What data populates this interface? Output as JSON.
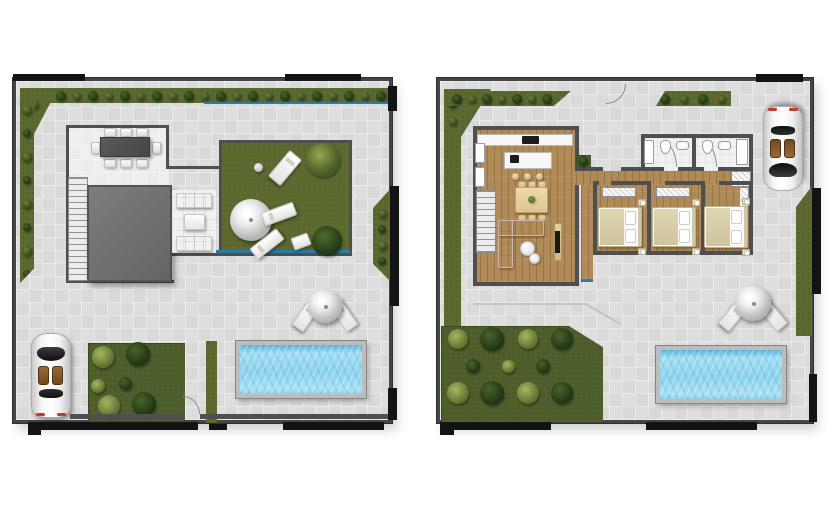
{
  "meta": {
    "canvas": {
      "width": 840,
      "height": 516
    },
    "plan_count": 2
  },
  "palette": {
    "paving": "#dedede",
    "wall": "#4f4f4f",
    "hedge": "#5c6a30",
    "lawn": "#5d6b31",
    "garden": "#50602c",
    "wood": "#b18b57",
    "teal": "#2a7ca6",
    "pool_water": "#8bd3ee",
    "pool_frame": "#bdbdbd",
    "bush_dark": "#1f3314",
    "bush_light": "#a3b75f",
    "sofa_pink": "#f0e2e0",
    "bed_blanket": "#d8cfae",
    "car_body": "#ffffff",
    "car_seats": "#8a5c2c",
    "shadow": "#131313"
  },
  "plans": {
    "left": {
      "name": "roof-terrace-site-plan",
      "features": [
        "perimeter-hedge",
        "dining-table-8-chairs",
        "stair-core-block",
        "roof-stairs",
        "lounge-sofa-set",
        "roof-garden-lawn",
        "sun-loungers",
        "parasols",
        "parked-convertible-car",
        "garden-patch",
        "swimming-pool",
        "entrance-gate",
        "glass-balustrade"
      ],
      "counts": {
        "sun_loungers": 6,
        "parasols": 2,
        "trees": 2,
        "cars": 1,
        "pools": 1,
        "dining_chairs": 8,
        "sofas": 2
      },
      "bush_groups": {
        "hedge_top": {
          "container": "lp-hedge-top",
          "count": 23,
          "d": 10,
          "tones": [
            "dark",
            "mid"
          ]
        },
        "hedge_left": {
          "container": "lp-hedge-left",
          "count": 8,
          "d": 10,
          "axis": "y",
          "tones": [
            "mid",
            "dark"
          ]
        },
        "hedge_corner": {
          "container": "lp-hedge-corner",
          "items": [
            {
              "x": 14,
              "y": 16,
              "d": 9,
              "tone": "mid"
            },
            {
              "x": 8,
              "y": 33,
              "d": 8,
              "tone": "dark"
            }
          ]
        },
        "right_strip": {
          "container": "lp-right-strip",
          "items": [
            {
              "x": 9,
              "y": 26,
              "d": 9,
              "tone": "mid"
            },
            {
              "x": 9,
              "y": 42,
              "d": 8,
              "tone": "dark"
            },
            {
              "x": 9,
              "y": 58,
              "d": 9,
              "tone": "mid"
            },
            {
              "x": 9,
              "y": 74,
              "d": 8,
              "tone": "dark"
            }
          ]
        },
        "roof_garden_trees": {
          "container": "lp-roof-garden",
          "items": [
            {
              "x": 101,
              "y": 17,
              "d": 34,
              "tone": "tree-light"
            },
            {
              "x": 105,
              "y": 98,
              "d": 30,
              "tone": "tree-dark"
            }
          ]
        },
        "garden_patch": {
          "container": "lp-garden",
          "items": [
            {
              "x": 15,
              "y": 14,
              "d": 22,
              "tone": "light"
            },
            {
              "x": 50,
              "y": 11,
              "d": 24,
              "tone": "dark"
            },
            {
              "x": 10,
              "y": 43,
              "d": 14,
              "tone": "light"
            },
            {
              "x": 37,
              "y": 40,
              "d": 13,
              "tone": "dark"
            },
            {
              "x": 21,
              "y": 63,
              "d": 22,
              "tone": "light"
            },
            {
              "x": 56,
              "y": 61,
              "d": 24,
              "tone": "dark"
            }
          ]
        }
      }
    },
    "right": {
      "name": "ground-floor-plan",
      "features": [
        "perimeter-hedge",
        "kitchen-counter",
        "kitchen-island",
        "dining-table-6-chairs",
        "living-room-sofa",
        "tv-unit",
        "staircase",
        "hallway",
        "bedrooms",
        "bathrooms",
        "shower",
        "wardrobes",
        "entry-planter",
        "parked-convertible-car",
        "garden",
        "swimming-pool",
        "sun-loungers",
        "parasol",
        "entrance-gate"
      ],
      "counts": {
        "bedrooms": 3,
        "beds": 3,
        "bathrooms": 2,
        "wardrobes": 3,
        "sun_loungers": 2,
        "parasols": 1,
        "cars": 1,
        "pools": 1,
        "dining_chairs": 6,
        "kitchen_stools": 3
      },
      "bush_groups": {
        "hedge_top_left": {
          "container": "rp-hedge-a",
          "count": 8,
          "d": 10,
          "tones": [
            "dark",
            "mid"
          ]
        },
        "hedge_top_right": {
          "container": "rp-hedge-b",
          "count": 4,
          "d": 10,
          "tones": [
            "dark",
            "mid"
          ]
        },
        "left_strip": {
          "container": "rp-left-strip",
          "items": [
            {
              "x": 8,
              "y": 14,
              "d": 9,
              "tone": "dark"
            },
            {
              "x": 9,
              "y": 32,
              "d": 8,
              "tone": "mid"
            }
          ]
        },
        "garden": {
          "container": "rp-garden",
          "items": [
            {
              "x": 17,
              "y": 13,
              "d": 20,
              "tone": "light"
            },
            {
              "x": 51,
              "y": 13,
              "d": 24,
              "tone": "dark"
            },
            {
              "x": 87,
              "y": 13,
              "d": 20,
              "tone": "light"
            },
            {
              "x": 121,
              "y": 13,
              "d": 22,
              "tone": "dark"
            },
            {
              "x": 32,
              "y": 40,
              "d": 14,
              "tone": "dark"
            },
            {
              "x": 67,
              "y": 40,
              "d": 13,
              "tone": "light"
            },
            {
              "x": 102,
              "y": 40,
              "d": 14,
              "tone": "dark"
            },
            {
              "x": 17,
              "y": 67,
              "d": 22,
              "tone": "light"
            },
            {
              "x": 51,
              "y": 67,
              "d": 24,
              "tone": "dark"
            },
            {
              "x": 87,
              "y": 67,
              "d": 22,
              "tone": "light"
            },
            {
              "x": 121,
              "y": 67,
              "d": 22,
              "tone": "dark"
            }
          ]
        },
        "planter": {
          "container": "rp-planter",
          "items": [
            {
              "x": 7,
              "y": 6,
              "d": 10,
              "tone": "dark"
            }
          ]
        }
      }
    }
  }
}
